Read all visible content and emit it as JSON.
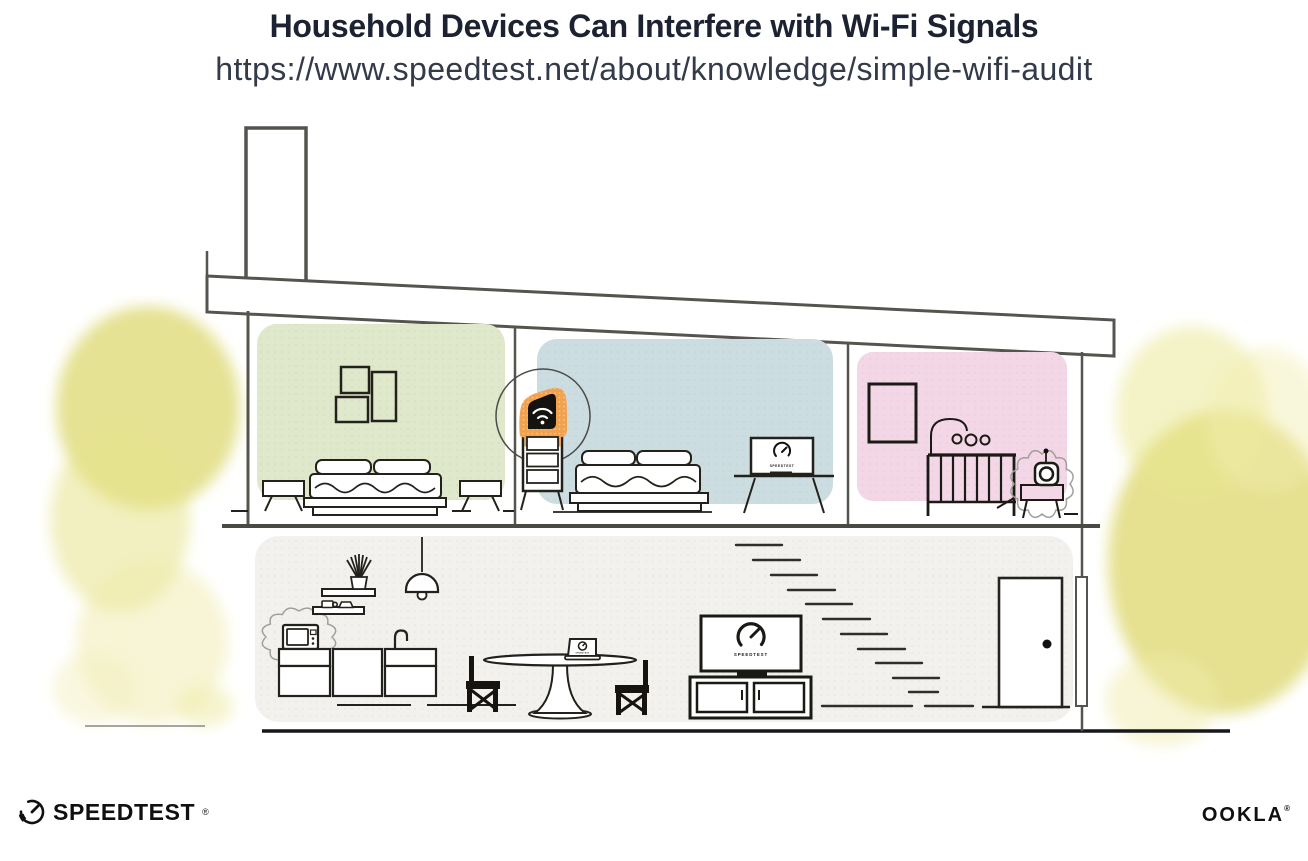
{
  "header": {
    "title": "Household Devices Can Interfere with Wi-Fi Signals",
    "url": "https://www.speedtest.net/about/knowledge/simple-wifi-audit"
  },
  "screens": {
    "tv_label": "SPEEDTEST",
    "bedroom_monitor_label": "SPEEDTEST",
    "laptop_label": "SPEEDTEST"
  },
  "footer": {
    "speedtest_wordmark": "SPEEDTEST",
    "speedtest_registered": "®",
    "ookla_wordmark": "OOKLA",
    "ookla_registered": "®"
  },
  "icons": {
    "wifi_router": "wifi-icon",
    "speedtest_gauge": "gauge-icon",
    "microwave_interference": "starburst-outline-icon",
    "baby_monitor_interference": "starburst-outline-icon"
  },
  "colors": {
    "title_ink": "#1c2231",
    "structure_line": "#55544e",
    "furniture_ink": "#17150f",
    "router_orange": "#f0a24f",
    "room_green": "#dfe8cb",
    "room_blue": "#ccdde1",
    "room_pink": "#f3d7e6",
    "lower_floor_gray": "#f2f1ee",
    "foliage_yellow": "#dfda75"
  }
}
